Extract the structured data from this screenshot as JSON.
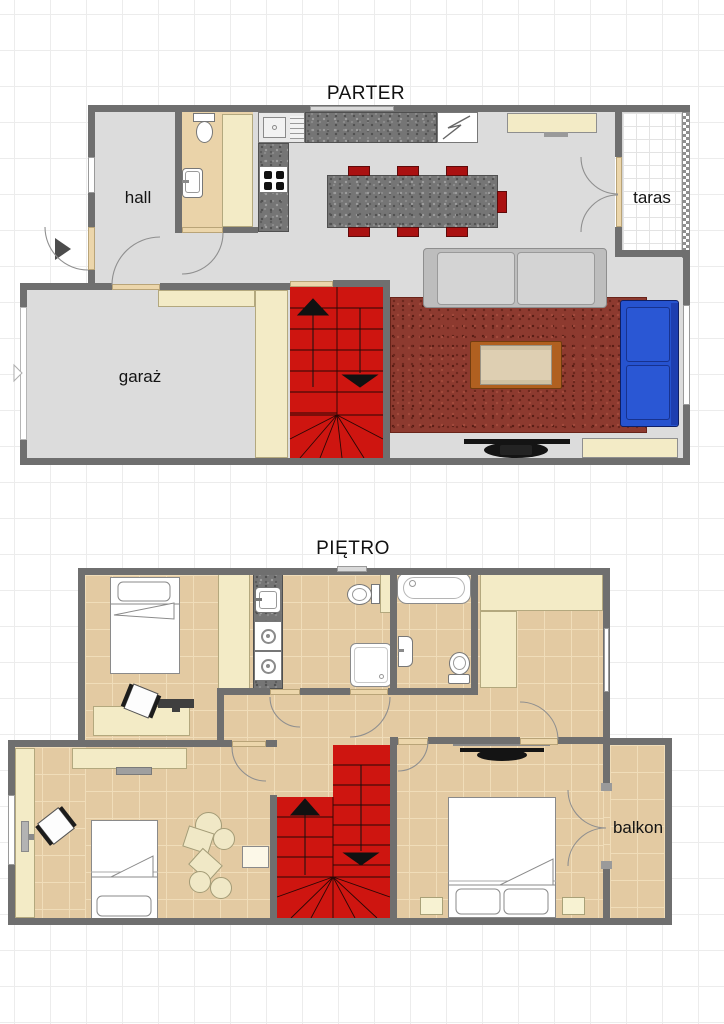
{
  "floors": [
    {
      "title": "PARTER",
      "rooms": [
        {
          "name": "hall",
          "label": "hall"
        },
        {
          "name": "garage",
          "label": "garaż"
        },
        {
          "name": "terrace",
          "label": "taras"
        }
      ],
      "fixtures": [
        "entry-door",
        "wc-toilet",
        "wc-sink",
        "closet",
        "kitchen-sink",
        "stove-burners",
        "fridge",
        "kitchen-counter",
        "dining-island",
        "dining-chairs",
        "sideboard",
        "sofa",
        "chaise-lounge",
        "coffee-table",
        "tv",
        "rug",
        "stairs"
      ]
    },
    {
      "title": "PIĘTRO",
      "rooms": [
        {
          "name": "balcony",
          "label": "balkon"
        }
      ],
      "fixtures": [
        "bed",
        "wardrobe",
        "laundry-sink",
        "washer",
        "dryer",
        "toilet",
        "shower",
        "bathtub",
        "bathroom-sink",
        "desk",
        "office-chair",
        "monitor",
        "poufs",
        "side-table",
        "tv-shelf",
        "tv",
        "double-bed",
        "nightstands",
        "balcony-door",
        "stairs"
      ]
    }
  ],
  "colors": {
    "wall": "#6f6f6f",
    "floor_ground": "#dcdcdc",
    "floor_upper": "#e3caa2",
    "floor_upper_grid": "#f0ddb9",
    "furniture_cream": "#f3ebc6",
    "stairs_red": "#ce1510",
    "chair_red": "#aa1111",
    "sofa_blue": "#2653cf",
    "rug_red": "#8d3a2f",
    "granite": "#757575",
    "threshold": "#ecd6ab",
    "page_grid": "#ececec"
  }
}
